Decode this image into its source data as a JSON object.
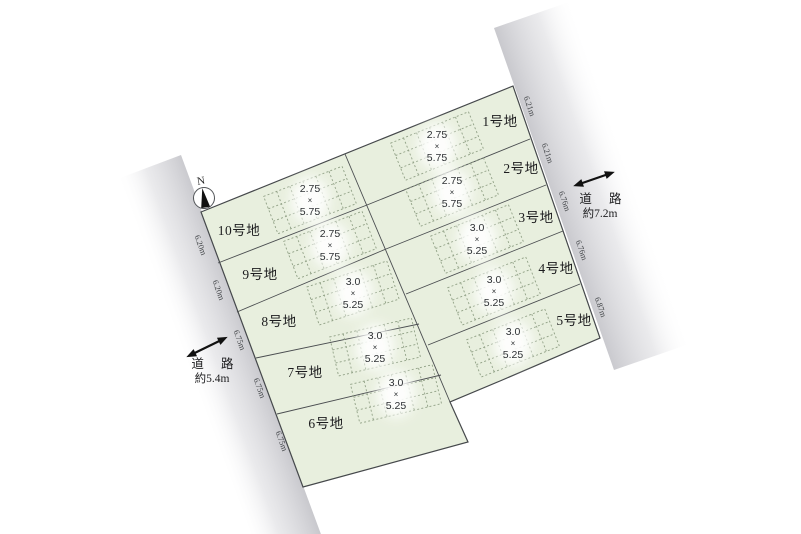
{
  "colors": {
    "parcel_fill": "#e8efde",
    "parcel_stroke": "#45484b",
    "grid_stroke": "#90a085",
    "road_gray": "#c6c6cb"
  },
  "north": {
    "label": "N"
  },
  "sym": {
    "times": "×"
  },
  "roads": {
    "right": {
      "name": "道 路",
      "width": "約7.2m"
    },
    "left": {
      "name": "道 路",
      "width": "約5.4m"
    }
  },
  "edges": {
    "left": [
      "6.20m",
      "6.20m",
      "6.75m",
      "6.75m",
      "6.75m"
    ],
    "right": [
      "6.21m",
      "6.21m",
      "6.76m",
      "6.76m",
      "6.87m"
    ]
  },
  "plots": [
    {
      "label": "1号地",
      "w": "2.75",
      "h": "5.75"
    },
    {
      "label": "2号地",
      "w": "2.75",
      "h": "5.75"
    },
    {
      "label": "3号地",
      "w": "3.0",
      "h": "5.25"
    },
    {
      "label": "4号地",
      "w": "3.0",
      "h": "5.25"
    },
    {
      "label": "5号地",
      "w": "3.0",
      "h": "5.25"
    },
    {
      "label": "6号地",
      "w": "3.0",
      "h": "5.25"
    },
    {
      "label": "7号地",
      "w": "3.0",
      "h": "5.25"
    },
    {
      "label": "8号地",
      "w": "3.0",
      "h": "5.25"
    },
    {
      "label": "9号地",
      "w": "2.75",
      "h": "5.75"
    },
    {
      "label": "10号地",
      "w": "2.75",
      "h": "5.75"
    }
  ]
}
